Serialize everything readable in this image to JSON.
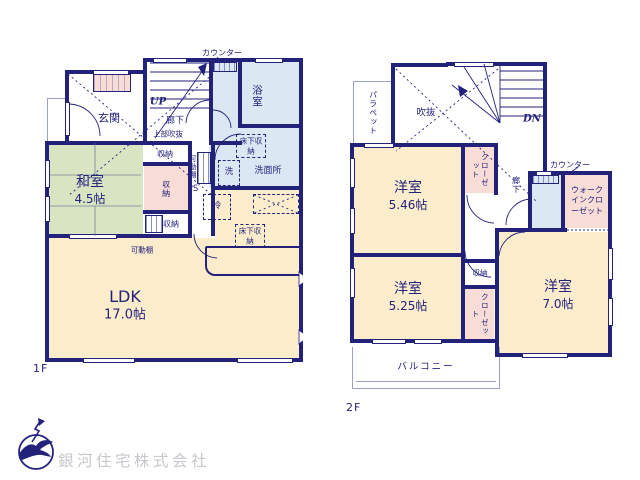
{
  "floor1": {
    "label": "1F",
    "counter": "カウンター",
    "bath": "浴室",
    "entrance": "玄関",
    "stairs": "UP",
    "hallway": "廊下",
    "upper_void": "上部吹抜",
    "storage_top": "収納",
    "storage_mid": "収納",
    "storage_bottom": "収納",
    "movable_shelf": "可動棚",
    "movable_shelf2": "可動棚",
    "ps": "PS",
    "underfloor_storage": "床下収納",
    "washroom": "洗面所",
    "laundry": "洗",
    "washitsu": "和室",
    "washitsu_size": "4.5帖",
    "fridge": "冷",
    "underfloor_storage2": "床下収納",
    "ldk": "LDK",
    "ldk_size": "17.0帖"
  },
  "floor2": {
    "label": "2F",
    "parapet": "パラペット",
    "void": "吹抜",
    "stairs": "DN",
    "counter": "カウンター",
    "hallway": "廊下",
    "room_a": "洋室",
    "room_a_size": "5.46帖",
    "closet_a": "クローゼット",
    "wic": "ウォークインクローゼット",
    "storage": "収納",
    "room_b": "洋室",
    "room_b_size": "5.25帖",
    "closet_b": "クローゼット",
    "room_c": "洋室",
    "room_c_size": "7.0帖",
    "balcony": "バルコニー"
  },
  "footer": {
    "company": "銀河住宅株式会社"
  },
  "colors": {
    "wall": "#23227b",
    "tatami": "#d9e5c2",
    "wood_floor": "#fbeccb",
    "wet_area": "#dce7f4",
    "closet": "#f8dcd6",
    "light_outline": "#9aa0c8",
    "logo_text": "#c7c7cc"
  }
}
